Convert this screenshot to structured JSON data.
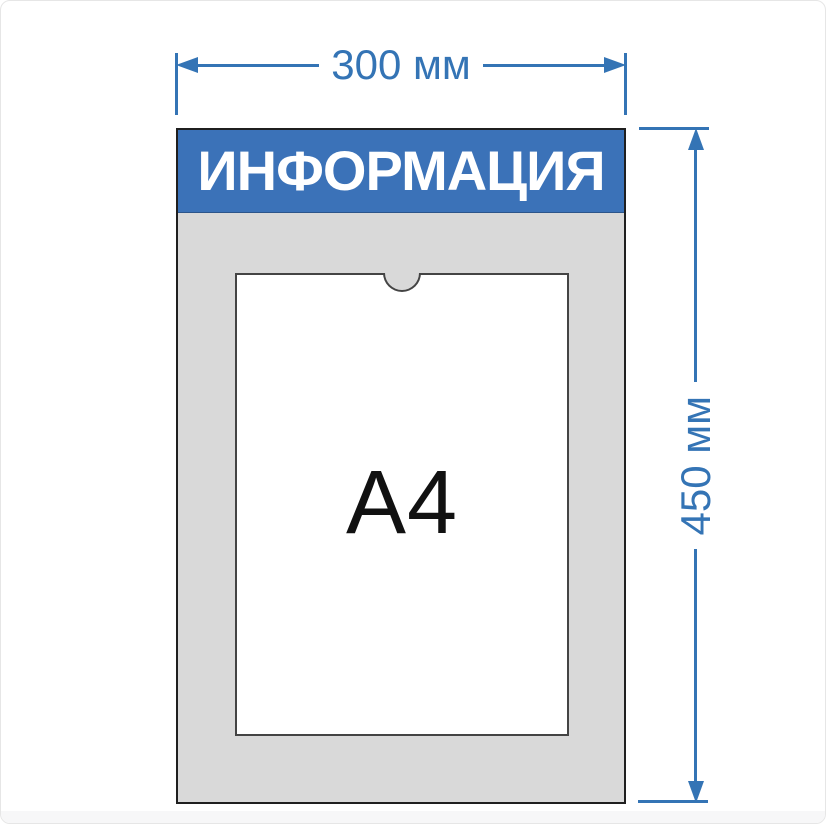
{
  "diagram": {
    "board": {
      "header_label": "ИНФОРМАЦИЯ",
      "pocket_label": "A4"
    },
    "dimensions": {
      "width": {
        "label": "300 мм",
        "value_mm": 300
      },
      "height": {
        "label": "450 мм",
        "value_mm": 450
      }
    }
  },
  "colors": {
    "header_blue": "#3b72b8",
    "dimension_blue": "#3474b5",
    "board_gray": "#d9d9d9",
    "board_border": "#1f1f1f",
    "pocket_border": "#444444",
    "pocket_white": "#ffffff",
    "a4_text": "#111111",
    "page_bg": "#ffffff",
    "page_border": "#e6e6e6",
    "footer_strip": "#f7f7f8"
  }
}
